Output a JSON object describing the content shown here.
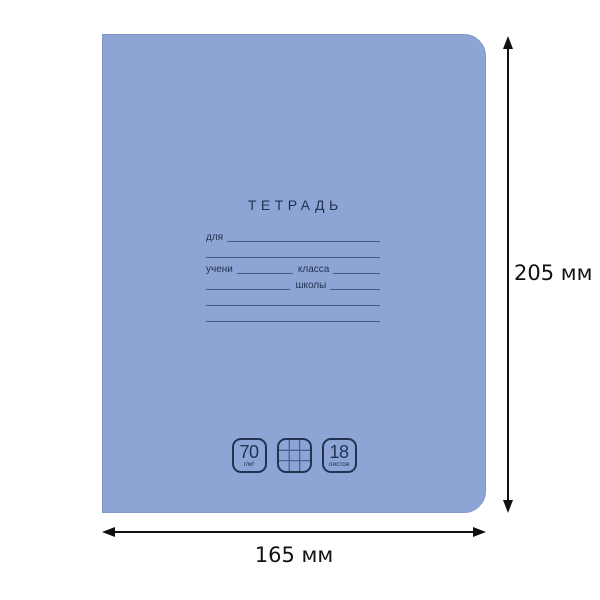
{
  "scene": {
    "background_color": "#ffffff",
    "description": "notebook-cover-dimension-diagram"
  },
  "notebook": {
    "cover_color": "#8ca5d5",
    "cover_edge_color": "#7f97c8",
    "ink_color": "#243252",
    "title": "ТЕТРАДЬ",
    "form": {
      "for_label": "для",
      "owner_label": "учени",
      "class_label": "класса",
      "school_label": "школы"
    },
    "badges": {
      "density_value": "70",
      "density_unit": "г/м²",
      "ruling_icon": "square-grid-icon",
      "sheets_value": "18",
      "sheets_unit": "листов"
    }
  },
  "dimensions": {
    "arrow_color": "#111111",
    "height_label": "205 мм",
    "width_label": "165 мм"
  }
}
